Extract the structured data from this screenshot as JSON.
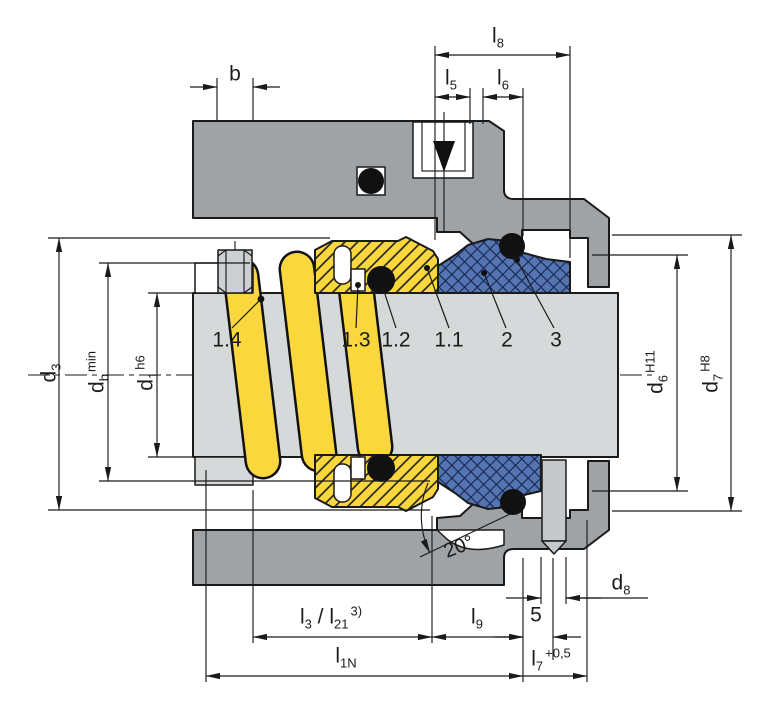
{
  "drawing_kind": "mechanical-seal-cross-section",
  "dims": {
    "b": {
      "base": "b"
    },
    "l8": {
      "base": "l",
      "sub": "8"
    },
    "l5": {
      "base": "l",
      "sub": "5"
    },
    "l6": {
      "base": "l",
      "sub": "6"
    },
    "d3": {
      "base": "d",
      "sub": "3"
    },
    "db": {
      "base": "d",
      "sub": "b",
      "tol": "min"
    },
    "d1": {
      "base": "d",
      "sub": "1",
      "tol": "h6"
    },
    "d6": {
      "base": "d",
      "sub": "6",
      "tol": "H11"
    },
    "d7": {
      "base": "d",
      "sub": "7",
      "tol": "H8"
    },
    "d8": {
      "base": "d",
      "sub": "8"
    },
    "l3l21": {
      "base": "l",
      "sub": "3",
      "base2": " / l",
      "sub2": "21",
      "tol": "3)"
    },
    "l9": {
      "base": "l",
      "sub": "9"
    },
    "five": {
      "base": "5"
    },
    "l1n": {
      "base": "l",
      "sub": "1N"
    },
    "l7": {
      "base": "l",
      "sub": "7",
      "tol": "+0,5"
    },
    "angle": {
      "base": "20°"
    }
  },
  "parts": {
    "p14": "1.4",
    "p13": "1.3",
    "p12": "1.2",
    "p11": "1.1",
    "p2": "2",
    "p3": "3"
  },
  "colors": {
    "housing": "#9fa3a6",
    "shaft": "#d6d9da",
    "screw": "#cdd0d3",
    "spring_yellow": "#fbd73e",
    "seat_blue": "#5474b2",
    "oring_black": "#111111",
    "line": "#1a1a1a"
  }
}
